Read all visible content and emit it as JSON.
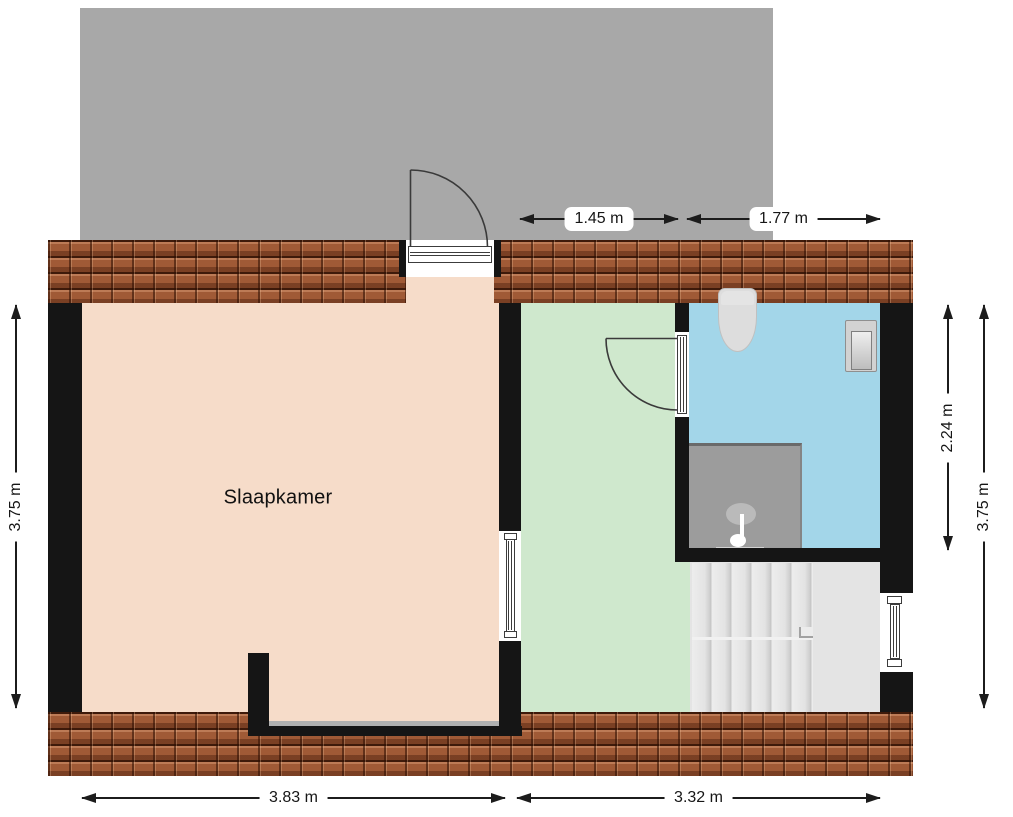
{
  "rooms": {
    "bedroom_label": "Slaapkamer"
  },
  "dimensions": {
    "top": [
      "1.45 m",
      "1.77 m"
    ],
    "left": [
      "3.75 m"
    ],
    "right": [
      "2.24 m",
      "3.75 m"
    ],
    "bottom": [
      "3.83 m",
      "3.32 m"
    ]
  },
  "fixtures": [
    "toilet-icon",
    "sink-icon",
    "shower-icon",
    "stairs",
    "exterior-door",
    "interior-door",
    "interior-window",
    "exterior-window"
  ],
  "colors": {
    "upper_floor": "#a8a8a8",
    "roof_tile": "#a05a36",
    "wall": "#151515",
    "bedroom": "#f6dcc9",
    "landing": "#cfe8cd",
    "bathroom": "#a3d6e9",
    "stairs": "#e4e4e4",
    "shower": "#9c9c9c",
    "fixture": "#dddddd",
    "dimension_text": "#161616"
  }
}
